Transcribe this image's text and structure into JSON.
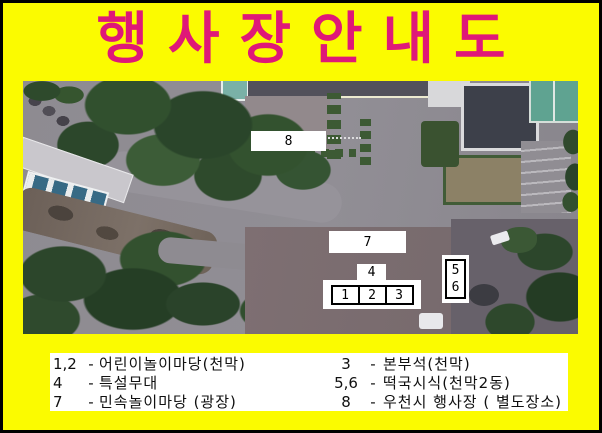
{
  "title": {
    "text": "행사장안내도"
  },
  "colors": {
    "frame_background": "#fbfb00",
    "frame_border": "#000000",
    "title_color": "#df1878",
    "legend_background": "#ffffff",
    "legend_text": "#101010",
    "marker_background": "#ffffff",
    "marker_text": "#000000"
  },
  "map": {
    "description": "aerial-photo",
    "markers": {
      "m1": "1",
      "m2": "2",
      "m3": "3",
      "m4": "4",
      "m5": "5",
      "m6": "6",
      "m7": "7",
      "m8": "8"
    }
  },
  "legend": {
    "dash": "-",
    "left": [
      {
        "num": "1,2",
        "label": "어린이놀이마당(천막)"
      },
      {
        "num": "4",
        "label": "특설무대"
      },
      {
        "num": "7",
        "label": "민속놀이마당 (광장)"
      }
    ],
    "right": [
      {
        "num": "3",
        "label": "본부석(천막)"
      },
      {
        "num": "5,6",
        "label": "떡국시식(천막2동)"
      },
      {
        "num": "8",
        "label": "우천시 행사장 ( 별도장소)"
      }
    ]
  }
}
